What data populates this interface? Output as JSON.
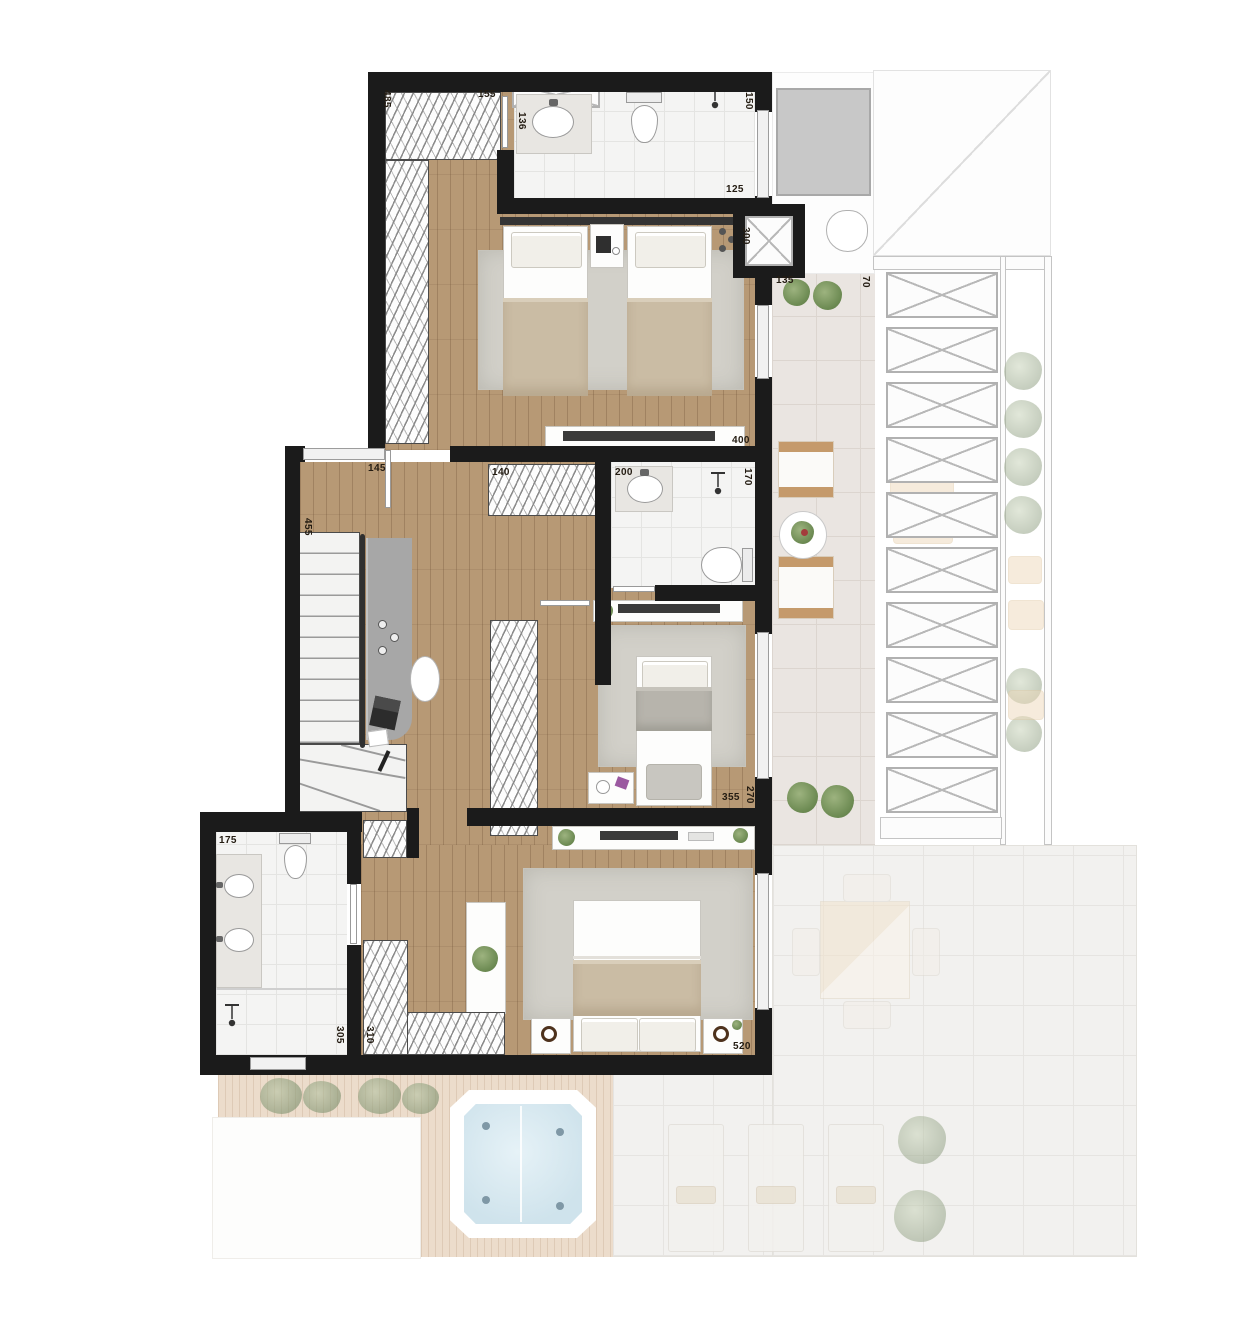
{
  "dims": {
    "closet_length": "485",
    "closet_width": "155",
    "bath1_vanity": "136",
    "bath1_width": "150",
    "bath1_length": "125",
    "bedroom1_length": "300",
    "terrace1_width": "135",
    "terrace1_gap": "70",
    "terrace1_length": "400",
    "terrace1_depth": "170",
    "hall_window": "145",
    "stair_run": "455",
    "closet2_width": "140",
    "bath2_width": "200",
    "bedroom2_width": "355",
    "bedroom2_depth": "270",
    "bath3_width": "175",
    "closet3_depth": "305",
    "closet3_width": "310",
    "master_width": "520"
  },
  "palette": {
    "wall": "#1b1b1b",
    "wood_floor": "#b79975",
    "bath_tile": "#f4f4f3",
    "terrace_tile": "#eae5e1",
    "deck": "#ecdccb",
    "rug": "#d2d0c9",
    "blanket": "#cabca4",
    "greenery": "#6c8a52",
    "water": "#d8e9f1"
  }
}
